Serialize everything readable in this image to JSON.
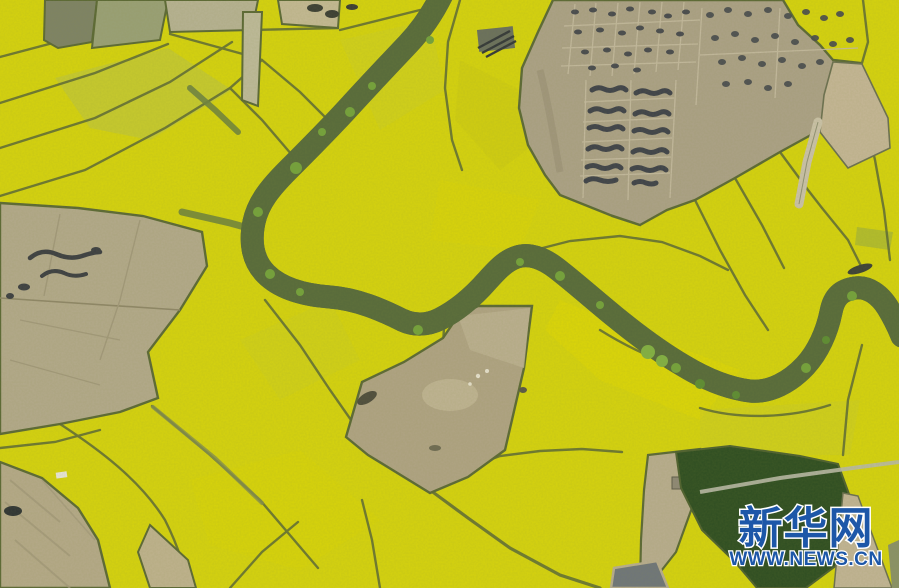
{
  "watermark": {
    "logo_text": "新华网",
    "url_text": "WWW.NEWS.CN",
    "text_color": "#1d57a8",
    "outline_color": "#ffffff"
  },
  "scene": {
    "type": "aerial-photograph",
    "subject": "rapeseed-flower-fields-with-winding-river",
    "palette": {
      "field_yellow": "#d6d30e",
      "field_pale_green": "#bcc247",
      "field_boundary": "#5b6836",
      "river_water": "#7b867f",
      "river_bank_green": "#57693c",
      "tree_green": "#74a23c",
      "plowed_brown": "#aca188",
      "soil_tan": "#c2b496",
      "dark_green_plot": "#2e4d22",
      "pond_gray": "#6f757b",
      "compost_pile_dark": "#3e414b"
    },
    "features": [
      {
        "name": "rapeseed-fields",
        "color": "#d6d30e"
      },
      {
        "name": "meandering-river",
        "color": "#7b867f"
      },
      {
        "name": "plowed-plots-with-compost-piles",
        "color": "#aca188"
      },
      {
        "name": "dark-green-tree-plot",
        "color": "#2e4d22"
      },
      {
        "name": "small-pond",
        "color": "#6f757b"
      }
    ]
  }
}
